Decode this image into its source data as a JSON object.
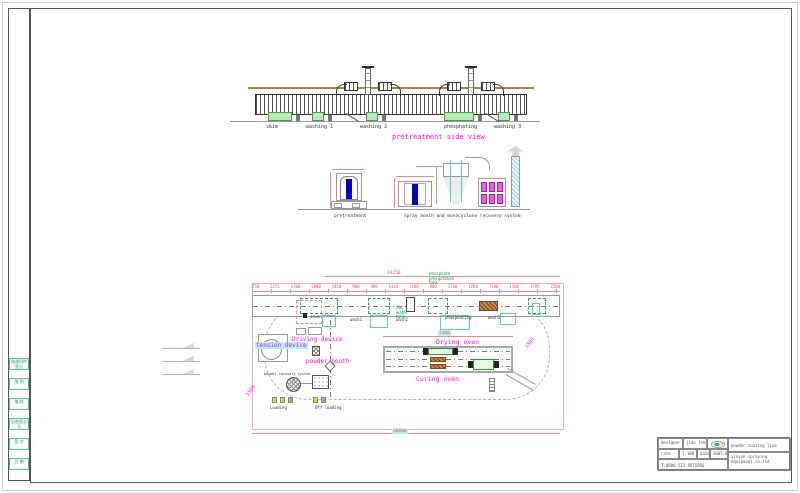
{
  "colors": {
    "label_magenta": "#ff00ff",
    "note_green": "#009944",
    "dim_red": "#e05555",
    "highlight_cyan": "#aef2f2",
    "tank_green": "#b7e8b7",
    "phosphate_brown": "#c98a4a",
    "tunnel_blue": "#0000cc"
  },
  "side_view": {
    "title": "pretreatment side view",
    "tanks": [
      "skim",
      "washing 1",
      "washing 2",
      "phosphating",
      "washing 3"
    ]
  },
  "elevations": {
    "pretreatment_label": "pretreatment",
    "spray_label": "spray booth and monocyclone recovery system"
  },
  "plan": {
    "overall_dim_top": "24250",
    "overall_dim_bottom": "30000",
    "oven_dim": "7300",
    "radius_dim_left": "1500",
    "radius_dim_right": "1500",
    "dims": [
      "750",
      "2275",
      "1700",
      "2000",
      "1450",
      "900",
      "900",
      "1443",
      "1180",
      "900",
      "1700",
      "1200",
      "7300",
      "1500",
      "1795",
      "2200"
    ],
    "phosphate_note_l1": "phosphate",
    "phosphate_note_l2": "precipitation",
    "phosphate_note_l3": "tank",
    "hot_water_l1": "hot",
    "hot_water_l2": "water",
    "hot_water_l3": "tank",
    "labels": {
      "driving": "Driving device",
      "tension": "tension device",
      "powder_booth": "powder booth",
      "powder_recovery": "powder recovery system",
      "drying": "Drying oven",
      "curing": "Curing oven",
      "loading": "Loading",
      "offloading": "Off loading",
      "skim": "skim",
      "wash1": "wash1",
      "wash2": "wash2",
      "phosphating": "phosphating",
      "wash3": "wash3"
    }
  },
  "title_block": {
    "designer_label": "designer",
    "designer_value": "jian feng",
    "rate_label": "rate",
    "rate_value": "1:100",
    "date_label": "date",
    "date_value": "2005.07",
    "phone": "T:0086-523-8675966",
    "product": "powder coating line",
    "company": "xinyue spraying equipment co,ltd"
  },
  "left_strip": {
    "cells": [
      "借通用件登记",
      "描 图",
      "描 校",
      "旧底图总号",
      "签 字",
      "日 期"
    ]
  }
}
